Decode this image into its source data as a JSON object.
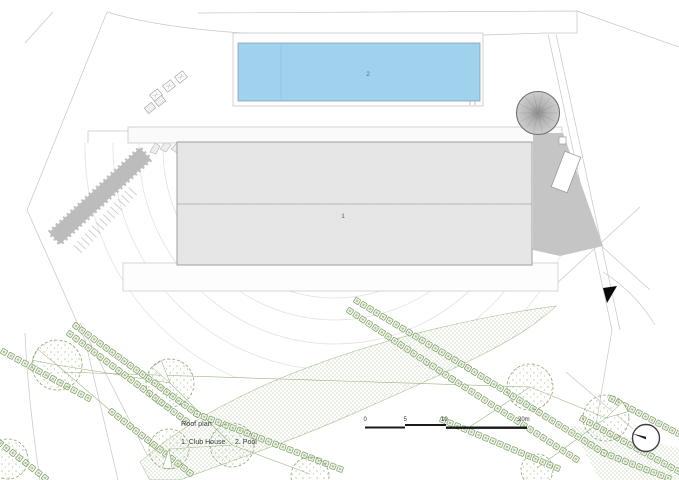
{
  "drawing": {
    "legend": {
      "title": "Roof plan",
      "item_club_house": "1. Club House",
      "item_pool": "2. Pool"
    },
    "labels": {
      "club_house": "1",
      "pool": "2"
    },
    "scale_bar": {
      "t0": "0",
      "t5": "5",
      "t10": "10",
      "t20": "20m"
    },
    "colors": {
      "pool_fill": "#a0d2ee",
      "roof_fill": "#e9e9e9",
      "drive_fill": "#c5c5c5",
      "scrub_fill": "#bcbcbc",
      "green_line": "#7d9c62",
      "stipple_dot": "#9ab483"
    }
  }
}
